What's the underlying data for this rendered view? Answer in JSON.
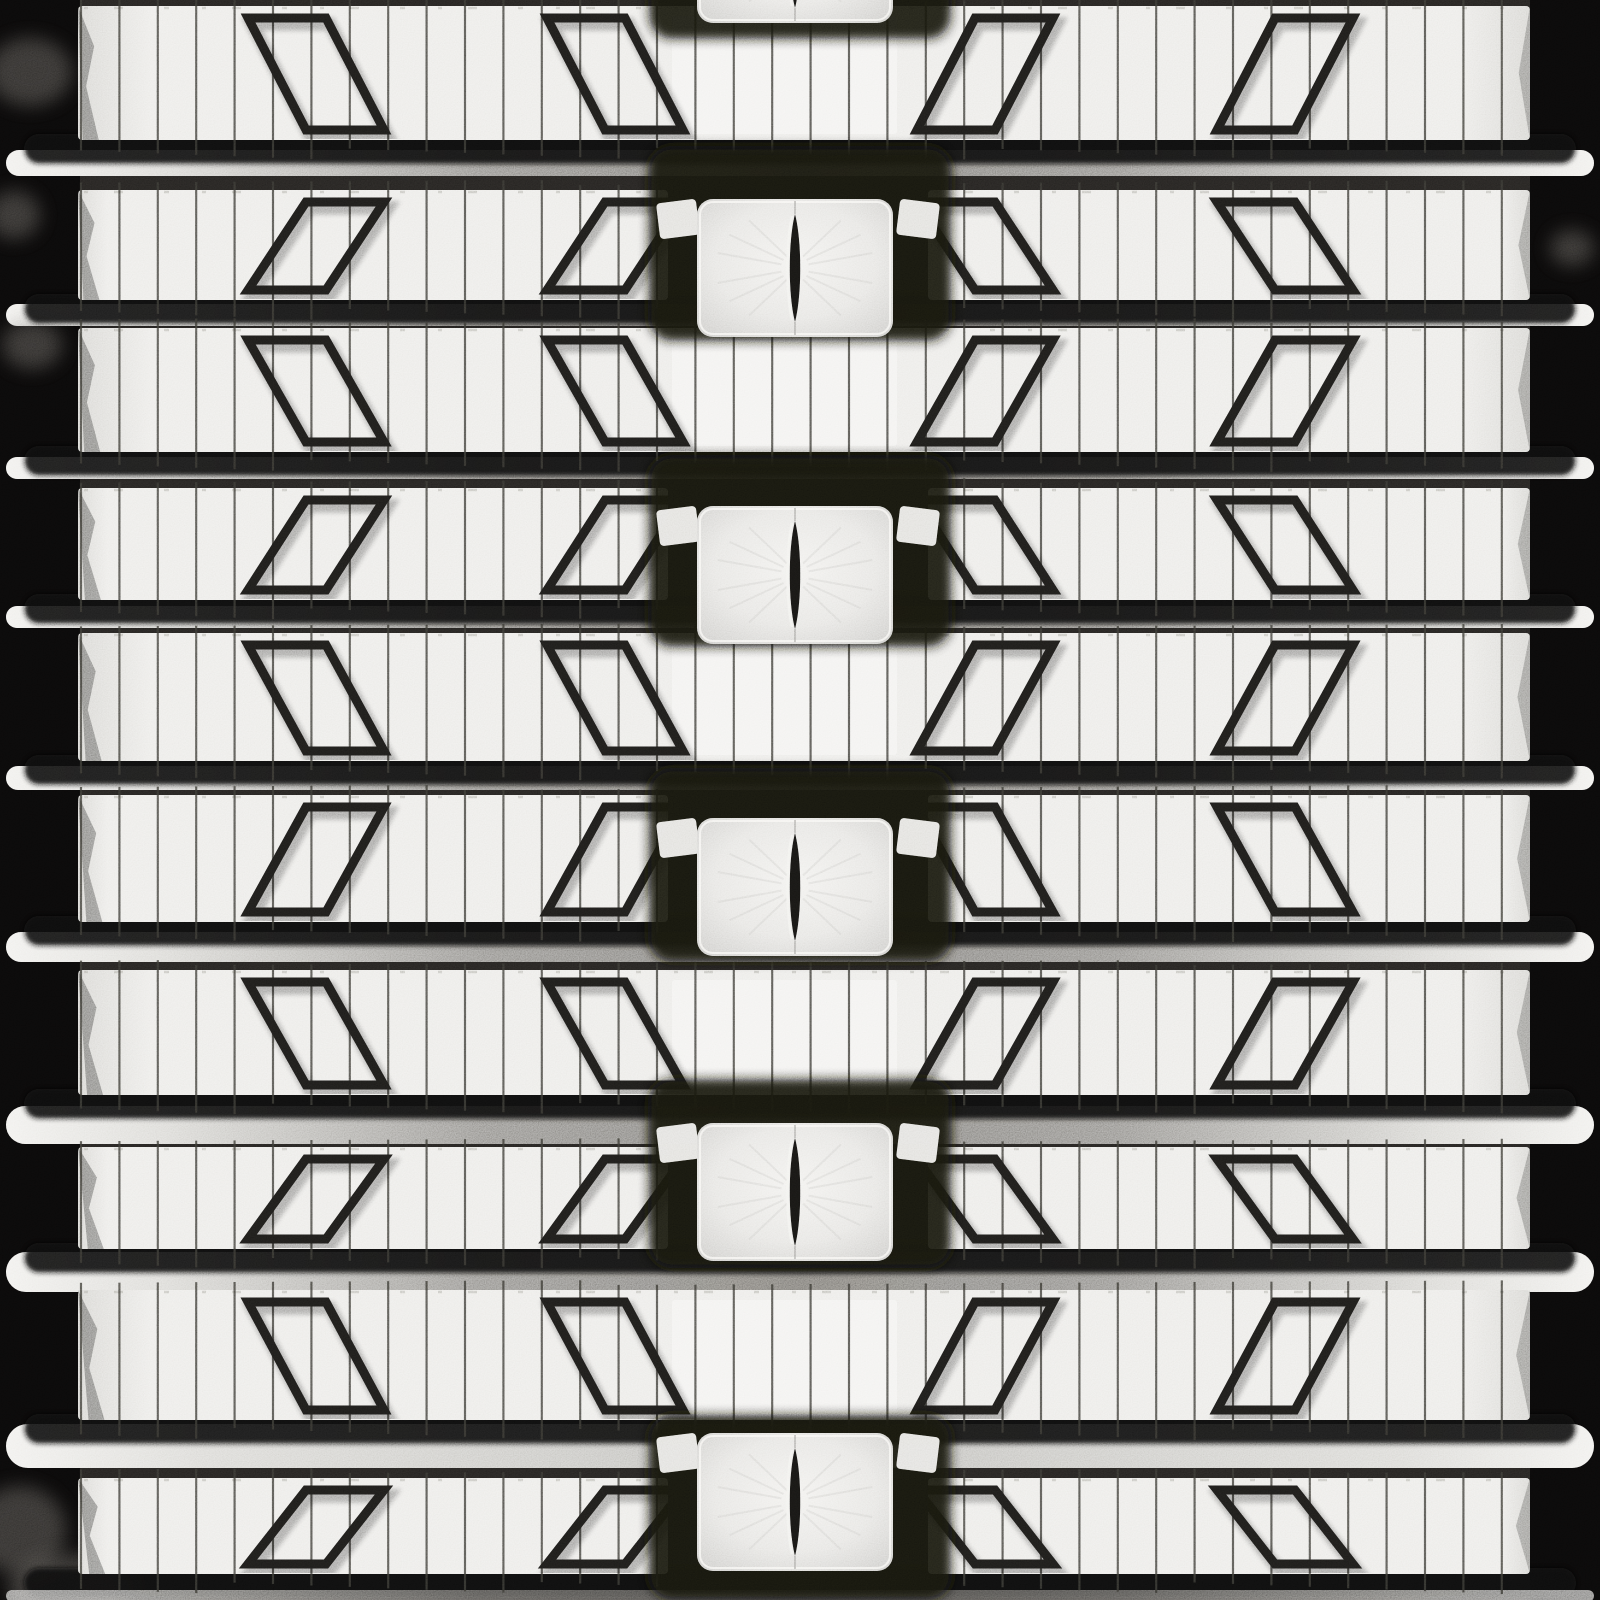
{
  "description": "Close-up photograph of a gray rubber track tread pattern: horizontal silver lug bars with thin vertical sipe wires, angled parallelogram grooves mirrored about the center, and a center column of square drive pads each with a vertical lens-shaped slit, on a black background",
  "palette": {
    "background": "#242220",
    "margin": "#0a0909",
    "bar": "#ebeae7",
    "bar_edge": "#d6d5d1",
    "bar_center_segment": "#f3f2ef",
    "bar_top_fleck": "#8b897f",
    "rail_bright": "#f0efec",
    "rail_step": "#d9d8d4",
    "rail_mid": "#918f8b",
    "rail_center": "#7b7975",
    "rail_bright_mid": "#c2c1bd",
    "shadow_pill": "#0f0e0d",
    "sipe": "#35342f",
    "groove": "#1c1b19",
    "groove_shadow": "#000000",
    "pad_center": "#f1f0ed",
    "pad_mid": "#e5e4e1",
    "pad_edge": "#c7c6c3",
    "pad_rim": "#f7f6f3",
    "pad_surround": "#131211",
    "pad_streak": "#b8b7b3",
    "slit": "#161513",
    "slit_highlight": "#f2f1ee",
    "haze": "#66645f",
    "torn_edge": "#141312"
  },
  "track": {
    "canvas": {
      "width": 1600,
      "height": 1600
    },
    "bar_left_x": 78,
    "bar_right_x": 1530,
    "even_left_bar_end": 668,
    "even_right_bar_start": 928,
    "center_segment": {
      "left": 672,
      "right": 897
    },
    "sipe_start_x": 81,
    "sipe_spacing": 38.4,
    "mark_centers_x": [
      316,
      615,
      985,
      1285
    ],
    "mark_top_width": 78,
    "mark_shear": 58,
    "mark_stroke_width": 9,
    "rows": [
      {
        "top": 6,
        "h": 134,
        "kind": "odd"
      },
      {
        "top": 190,
        "h": 110,
        "kind": "even"
      },
      {
        "top": 328,
        "h": 124,
        "kind": "odd"
      },
      {
        "top": 488,
        "h": 112,
        "kind": "even"
      },
      {
        "top": 633,
        "h": 128,
        "kind": "odd"
      },
      {
        "top": 795,
        "h": 127,
        "kind": "even"
      },
      {
        "top": 970,
        "h": 125,
        "kind": "odd"
      },
      {
        "top": 1147,
        "h": 102,
        "kind": "even"
      },
      {
        "top": 1290,
        "h": 130,
        "kind": "odd"
      },
      {
        "top": 1478,
        "h": 96,
        "kind": "even"
      }
    ],
    "rails": [
      {
        "y": 150,
        "h": 26
      },
      {
        "y": 304,
        "h": 22
      },
      {
        "y": 457,
        "h": 22
      },
      {
        "y": 606,
        "h": 22
      },
      {
        "y": 766,
        "h": 24
      },
      {
        "y": 932,
        "h": 30
      },
      {
        "y": 1106,
        "h": 38
      },
      {
        "y": 1252,
        "h": 40
      },
      {
        "y": 1424,
        "h": 44,
        "bright": true
      },
      {
        "y": 1590,
        "h": 12,
        "late": true
      }
    ],
    "rail_x": [
      6,
      1594
    ],
    "pads": [
      {
        "cx": 795,
        "cy": -46,
        "surround": [
          -160,
          40
        ]
      },
      {
        "cx": 795,
        "cy": 268,
        "surround": [
          146,
          342
        ]
      },
      {
        "cx": 795,
        "cy": 575,
        "surround": [
          455,
          648
        ]
      },
      {
        "cx": 795,
        "cy": 887,
        "surround": [
          768,
          962
        ]
      },
      {
        "cx": 795,
        "cy": 1192,
        "surround": [
          1078,
          1268
        ]
      },
      {
        "cx": 795,
        "cy": 1502,
        "surround": [
          1414,
          1600
        ]
      }
    ],
    "pad_size": {
      "w": 196,
      "h": 138,
      "radius": 16
    },
    "pad_surround_x": [
      648,
      952
    ],
    "slit": {
      "half_len": 54,
      "half_w": 7
    },
    "haze_blobs": [
      {
        "x": 30,
        "y": 72,
        "rx": 42,
        "ry": 34
      },
      {
        "x": 14,
        "y": 215,
        "rx": 26,
        "ry": 24
      },
      {
        "x": 32,
        "y": 345,
        "rx": 30,
        "ry": 24
      },
      {
        "x": 20,
        "y": 1530,
        "rx": 46,
        "ry": 44
      },
      {
        "x": 72,
        "y": 1588,
        "rx": 64,
        "ry": 34
      },
      {
        "x": 1572,
        "y": 248,
        "rx": 22,
        "ry": 18
      }
    ]
  }
}
